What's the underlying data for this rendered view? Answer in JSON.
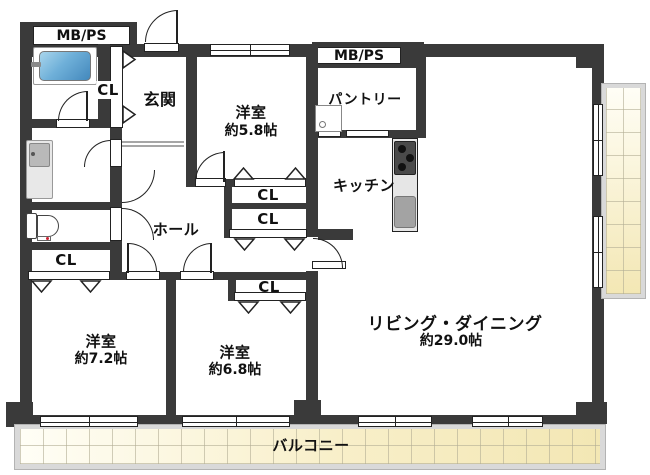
{
  "plan": {
    "title": "apartment-floor-plan",
    "rooms": {
      "genkan": {
        "label": "玄関"
      },
      "bedroom58": {
        "label": "洋室",
        "size": "約5.8帖"
      },
      "pantry": {
        "label": "パントリー"
      },
      "kitchen": {
        "label": "キッチン"
      },
      "hall": {
        "label": "ホール"
      },
      "living": {
        "label": "リビング・ダイニング",
        "size": "約29.0帖"
      },
      "bedroom72": {
        "label": "洋室",
        "size": "約7.2帖"
      },
      "bedroom68": {
        "label": "洋室",
        "size": "約6.8帖"
      },
      "balcony": {
        "label": "バルコニー"
      }
    },
    "labels": {
      "closet": "CL",
      "meter_pipe_space": "MB/PS"
    },
    "fixtures": [
      "bathtub",
      "vanity",
      "toilet",
      "stove",
      "sink",
      "pantry-cabinet"
    ],
    "colors": {
      "wall": "#3a3a3a",
      "bathtub": "#5b9fd0",
      "balcony_tile": "#f5ebc0",
      "balcony_frame": "#d9d9d9",
      "counter": "#e6e6e6",
      "stove": "#4a4a4a",
      "sink": "#a3a3a3"
    }
  }
}
